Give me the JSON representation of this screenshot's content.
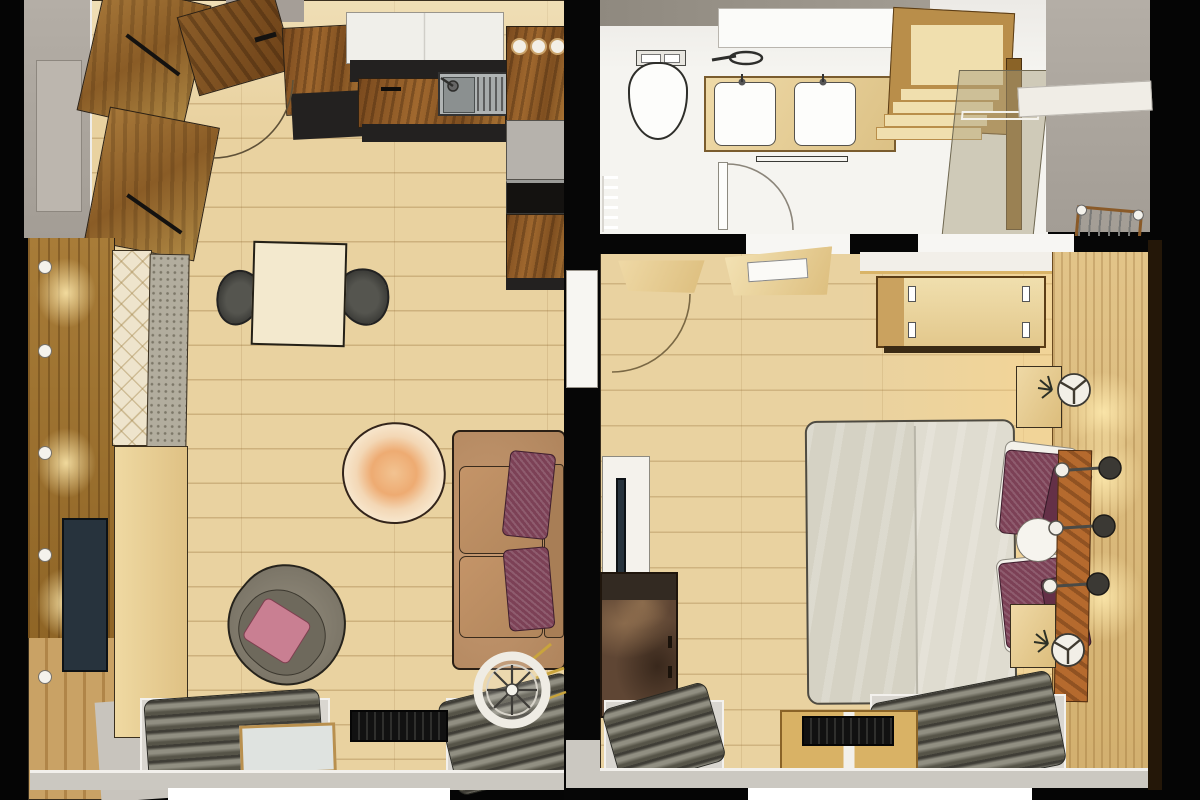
{
  "scene": {
    "title": "Apartment floor plan - 3D top-down render (living room with kitchen, bathroom, bedroom)"
  },
  "palette": {
    "wall": "#050505",
    "floor-wood": "#e9d2a0",
    "floor-bath": "#f5f4f0",
    "wall-gray": "#a39d95",
    "wall-taupe": "#8f897f",
    "entry-gray": "#a8a19a",
    "kitchen-wood": "#9a6130",
    "cabinet-dark": "#232120",
    "cabinet-white": "#f0efea",
    "steel": "#b0b4b4",
    "table-cream": "#f3e9ce",
    "chair-dark": "#474744",
    "sofa-tan": "#bd9069",
    "pillow-maroon": "#7c4156",
    "pillow-maroon-dark": "#643047",
    "pillow-pink": "#c97f92",
    "armchair-gray": "#8b8477",
    "rug-cream": "#f5ddc0",
    "bench-quilt": "#eee4cc",
    "bench-cushion": "#b2ad9e",
    "tv-dark": "#27333d",
    "media-wall-wood": "#9d7433",
    "lowboard-wood": "#e6cc93",
    "duvet-gray": "#d9d6c9",
    "linen-white": "#f3f1ea",
    "headboard-wood": "#b56a2e",
    "panel-wood": "#ddbd83",
    "stair-wood": "#f0dfae",
    "stair-edge": "#b98e4a",
    "radiator-dark": "#5d5b50",
    "terrace-gray": "#cbc8c1",
    "terrace-wood": "#c9a265",
    "door-wood": "#7d4c1f",
    "mat-black": "#151515",
    "lamp-white": "#f2efe7"
  },
  "rooms": [
    {
      "id": "living-room-kitchen",
      "label": "Living room with open kitchen",
      "items": [
        "entrance-door",
        "wardrobe",
        "kitchen-upper-cabinets",
        "kitchen-sink",
        "cooktop",
        "oven",
        "fridge",
        "dining-table",
        "dining-chairs",
        "tv-wall",
        "tv",
        "bench",
        "coffee-table",
        "armchair",
        "sofa",
        "pedestal-fan",
        "radiators",
        "balcony-door",
        "doormat"
      ]
    },
    {
      "id": "bathroom",
      "label": "Bathroom",
      "items": [
        "toilet",
        "double-vanity",
        "mirror",
        "towel-rail",
        "shower-glass-panel",
        "staircase",
        "bathroom-door"
      ]
    },
    {
      "id": "bedroom",
      "label": "Bedroom",
      "items": [
        "bedroom-door",
        "dresser-chest",
        "double-bed",
        "pillows",
        "headboard",
        "nightstands",
        "table-lamps",
        "wall-sconces",
        "tv-sideboard",
        "rustic-chest",
        "wood-panel-wall",
        "radiators",
        "balcony-door",
        "doormat"
      ]
    },
    {
      "id": "stairwell",
      "label": "Stairwell / landing",
      "items": [
        "stair-railing",
        "landing"
      ]
    }
  ]
}
